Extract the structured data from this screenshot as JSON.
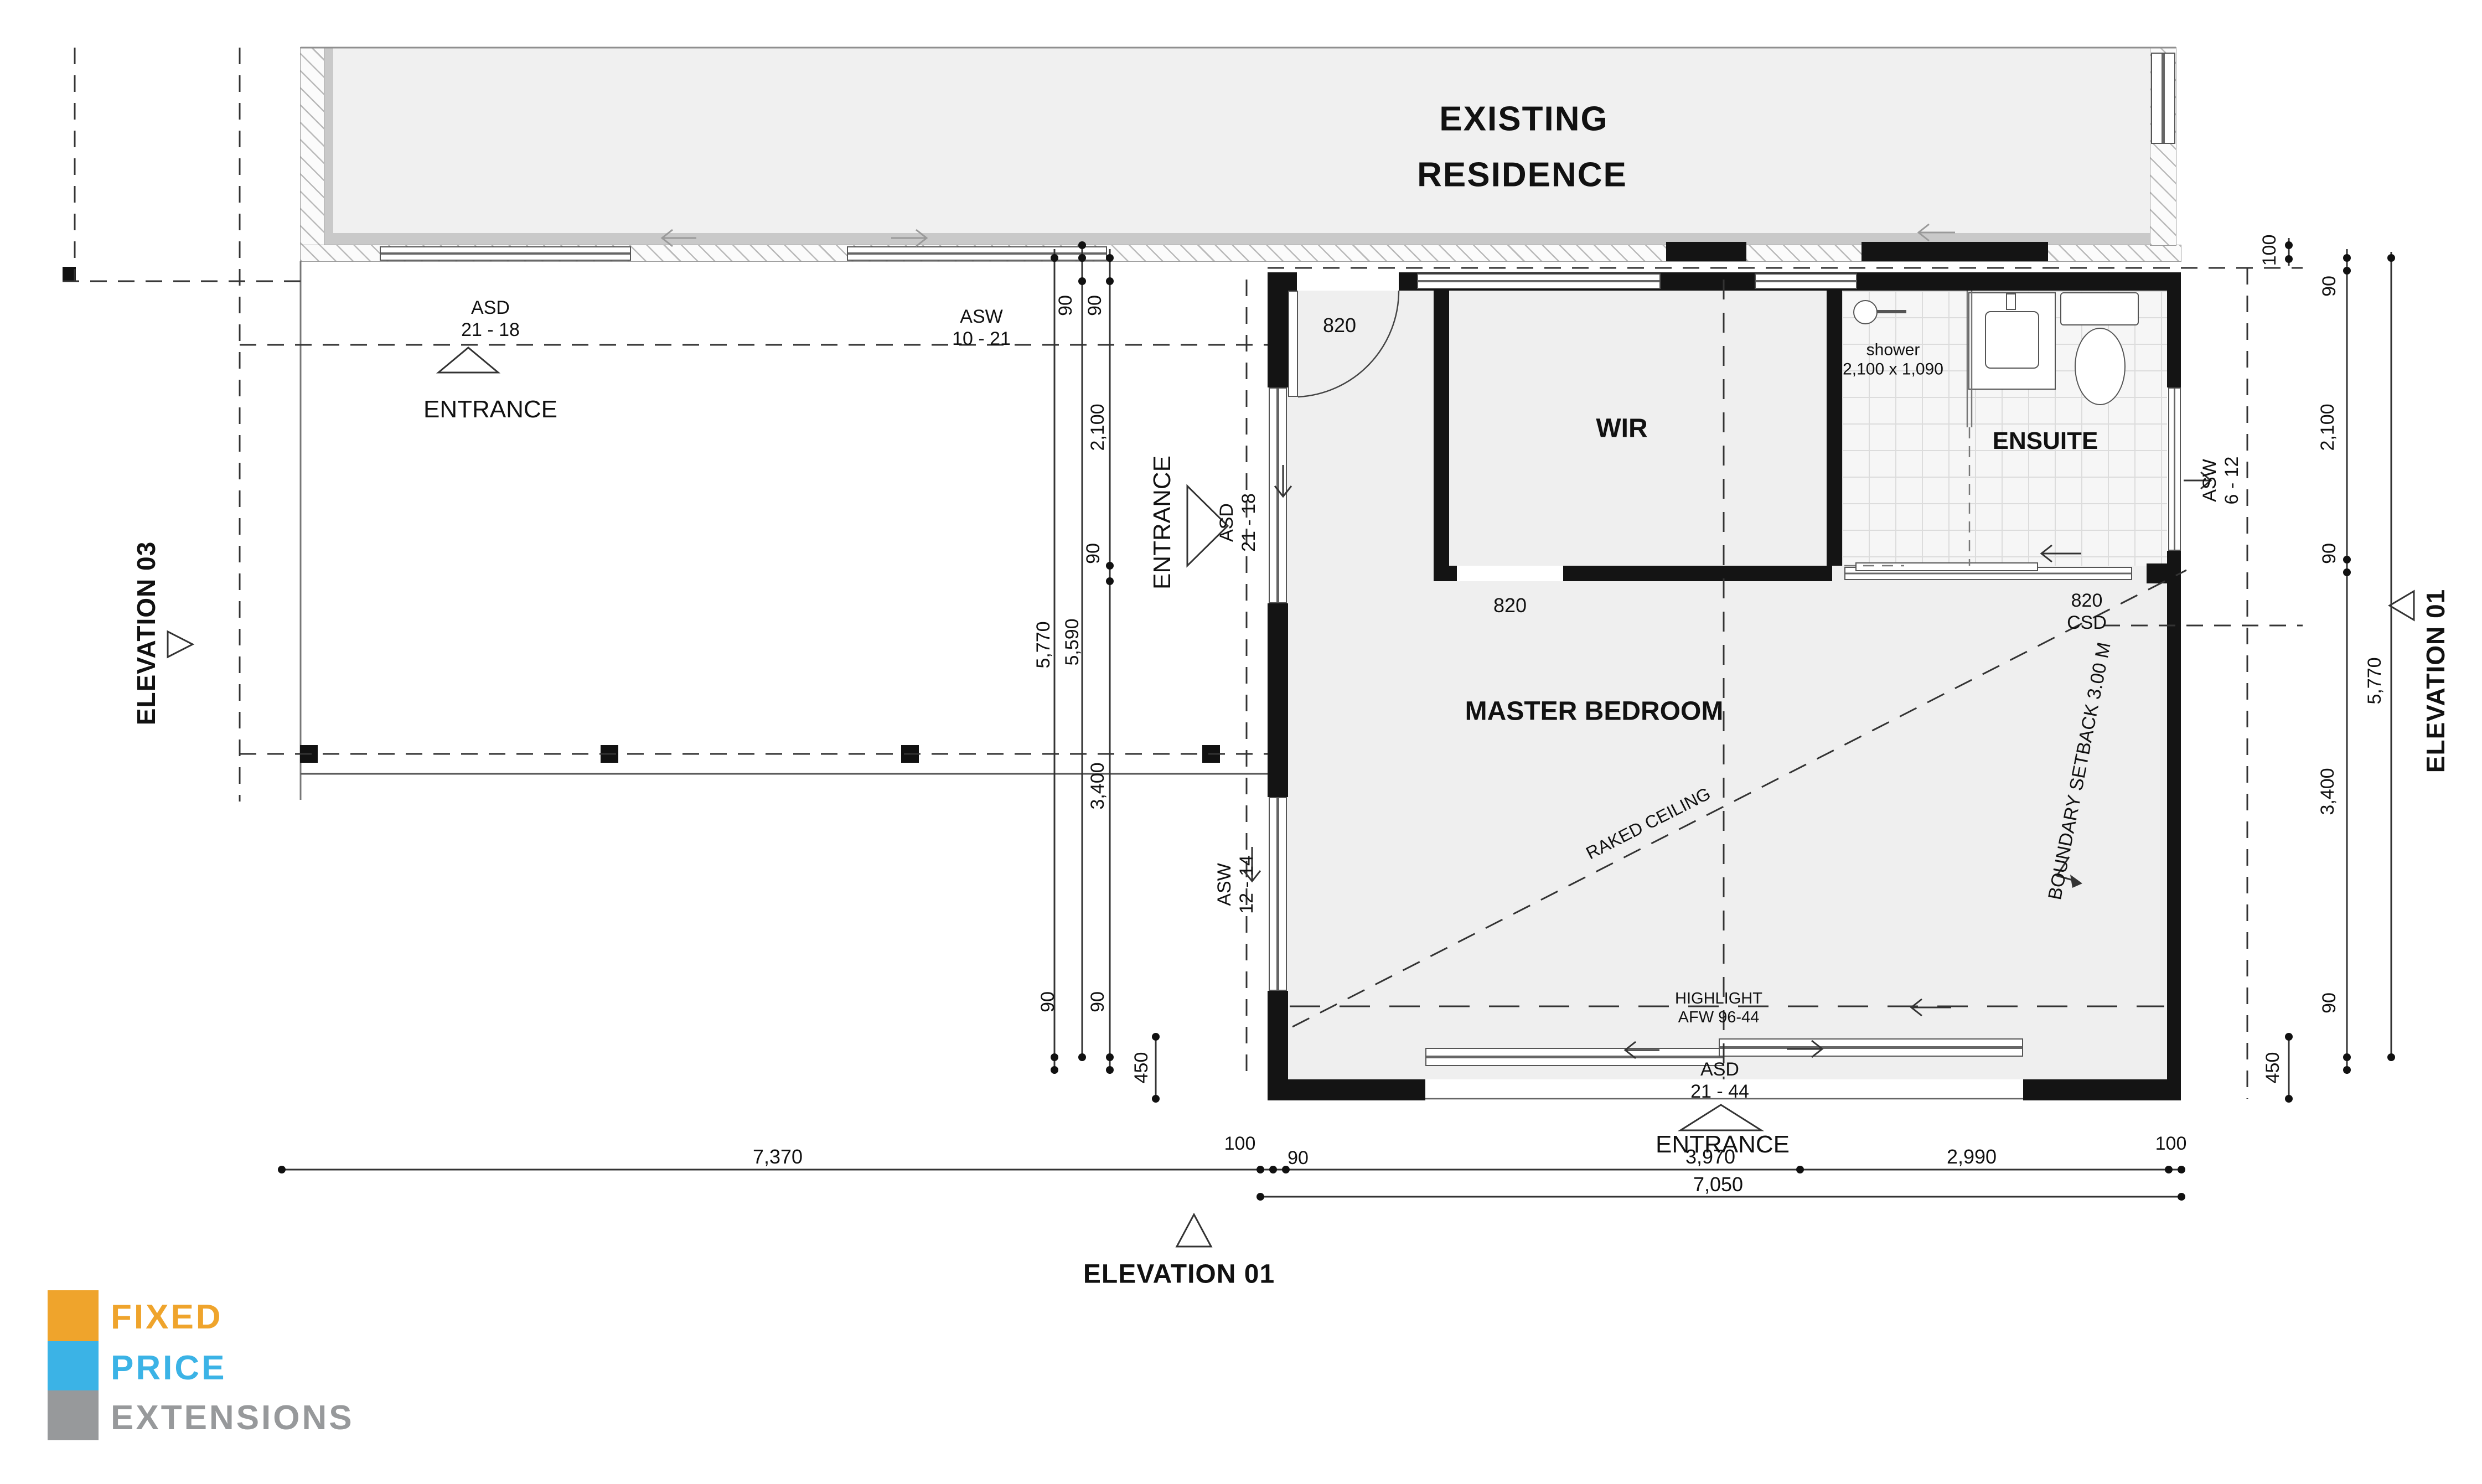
{
  "existing": {
    "title_line1": "EXISTING",
    "title_line2": "RESIDENCE"
  },
  "rooms": {
    "wir": "WIR",
    "ensuite": "ENSUITE",
    "master": "MASTER BEDROOM"
  },
  "openings": {
    "asd_top": {
      "code": "ASD",
      "num": "21 - 18"
    },
    "asw_top": {
      "code": "ASW",
      "num": "10 - 21"
    },
    "asd_side": {
      "code": "ASD",
      "num": "21 - 18"
    },
    "asw_side": {
      "code": "ASW",
      "num": "12 - 14"
    },
    "asw_ensuite": {
      "code": "ASW",
      "num": "6 - 12"
    },
    "asd_bottom": {
      "code": "ASD",
      "num": "21 - 44"
    },
    "highlight": {
      "line1": "HIGHLIGHT",
      "line2": "AFW 96-44"
    },
    "entry_door": "820",
    "wir_door": "820",
    "csd_door_line1": "820",
    "csd_door_line2": "CSD"
  },
  "annotations": {
    "entrance_top": "ENTRANCE",
    "entrance_side": "ENTRANCE",
    "entrance_bottom": "ENTRANCE",
    "raked_ceiling": "RAKED CEILING",
    "boundary_setback": "BOUNDARY SETBACK 3.00 M",
    "shower_line1": "shower",
    "shower_line2": "2,100 x 1,090"
  },
  "elevations": {
    "left": "ELEVATION 03",
    "right": "ELEVATION 01",
    "bottom": "ELEVATION 01"
  },
  "dimensions": {
    "center": {
      "wall_top_a": "90",
      "wall_top_b": "90",
      "wir_depth": "2,100",
      "wall_mid": "90",
      "overall": "5,770",
      "internal": "5,590",
      "bedroom": "3,400",
      "wall_bottom_a": "90",
      "wall_bottom_b": "90",
      "eave": "450"
    },
    "right": {
      "offset": "100",
      "wall_top": "90",
      "ensuite_depth": "2,100",
      "wall_mid": "90",
      "overall": "5,770",
      "bedroom": "3,400",
      "wall_bottom": "90",
      "eave": "450"
    },
    "bottom": {
      "existing_width": "7,370",
      "eave_left": "100",
      "wall_left": "90",
      "master_width": "3,970",
      "ensuite_width": "2,990",
      "eave_right": "100",
      "overall": "7,050"
    }
  },
  "logo": {
    "fixed": "FIXED",
    "price": "PRICE",
    "extensions": "EXTENSIONS",
    "colors": {
      "fixed": "#EFA42C",
      "price": "#3BB3E6",
      "extensions": "#97999B"
    }
  }
}
